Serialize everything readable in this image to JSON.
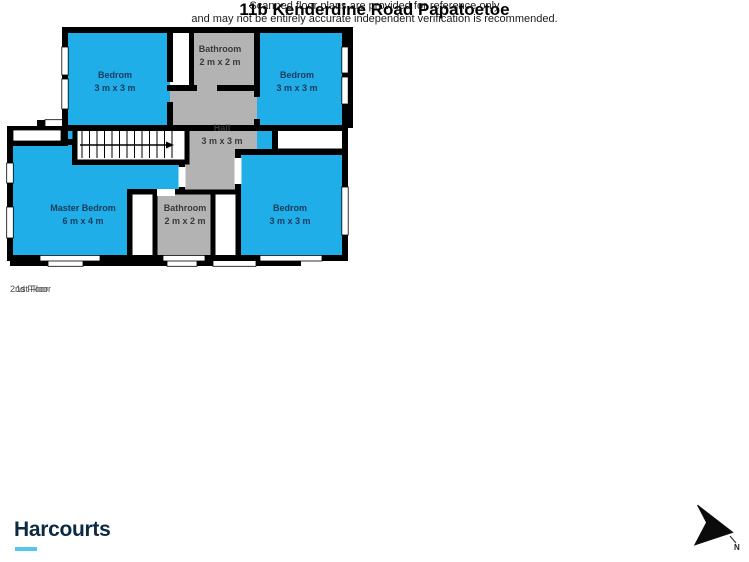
{
  "plans": [
    {
      "floor_label": "1st Floor",
      "rooms": [
        {
          "name": "Garage",
          "dims": "6 m x 3 m"
        },
        {
          "name": "Utility",
          "dims": "2 m x 1 m"
        },
        {
          "name": "W.c",
          "dims": "2 m x 1 m"
        },
        {
          "name": "Kitchen",
          "dims": "3 m x 4 m"
        },
        {
          "name": "Dining Area",
          "dims": "2 m x 3 m"
        },
        {
          "name": "Living Room",
          "dims": "3 m x 4 m"
        }
      ]
    },
    {
      "floor_label": "2nd Floor",
      "rooms": [
        {
          "name": "Bedrom",
          "dims": "3 m x 3 m"
        },
        {
          "name": "Bathroom",
          "dims": "2 m x 2 m"
        },
        {
          "name": "Bedrom",
          "dims": "3 m x 3 m"
        },
        {
          "name": "Hall",
          "dims": "3 m x 3 m"
        },
        {
          "name": "Master Bedrom",
          "dims": "6 m x 4 m"
        },
        {
          "name": "Bathroom",
          "dims": "2 m x 2 m"
        },
        {
          "name": "Bedrom",
          "dims": "3 m x 3 m"
        }
      ]
    }
  ],
  "footer": {
    "title": "11b Kenderdine Road Papatoetoe",
    "disclaimer_line1": "Scanned floor plans are provided for reference only",
    "disclaimer_line2": "and may not be entirely accurate independent verification is recommended.",
    "brand": "Harcourts",
    "compass_label": "N"
  },
  "colors": {
    "room_blue": "#1FAEE8",
    "room_gray": "#B3B3B3",
    "wall_black": "#000000",
    "brand_navy": "#0D2A43",
    "brand_accent": "#55C6EA"
  }
}
